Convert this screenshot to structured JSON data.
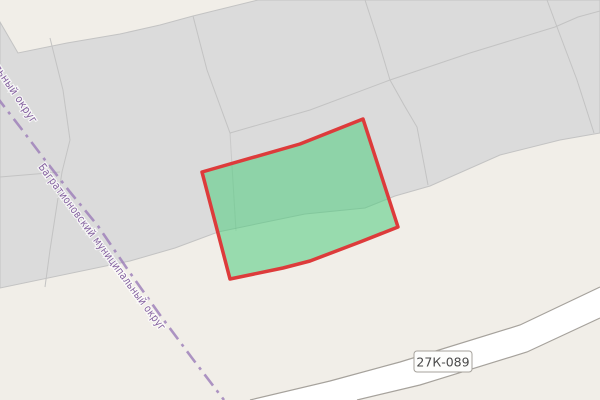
{
  "map": {
    "labels": {
      "admin_boundary_truncated": "альный округ",
      "admin_boundary": "Багратионовский муниципальный округ",
      "road_ref": "27К-089"
    },
    "colors": {
      "background": "#f1eee8",
      "parcel_area": "#dbdbdb",
      "parcel_border": "#c3c3c3",
      "selected_fill": "#4fcc7e",
      "selected_border": "#dd3b3b",
      "admin_boundary_line": "#9b7cb8",
      "admin_boundary_text": "#84619f",
      "road_fill": "#ffffff",
      "road_casing": "#a6a29c",
      "road_badge_fill": "#fdfdfc",
      "road_badge_text": "#4a4a4a"
    }
  }
}
